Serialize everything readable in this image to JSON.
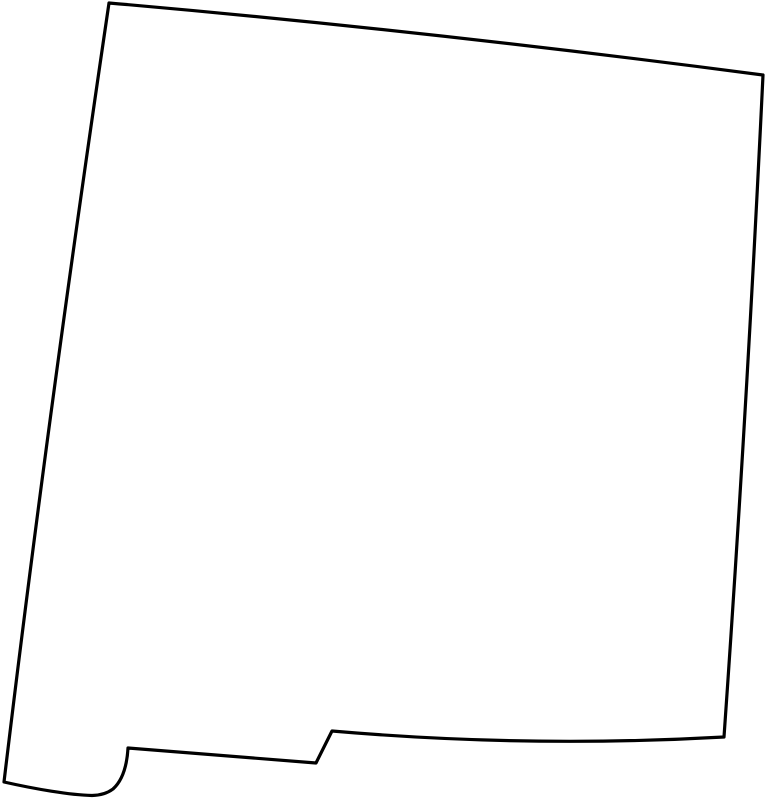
{
  "page": {
    "background_color": "#ffffff"
  },
  "map": {
    "region_label": "New Mexico",
    "kind": "blank-state-outline-map",
    "stroke_color": "#000000",
    "fill_color": "#ffffff",
    "stroke_width": "3.2",
    "viewbox": "0 0 769 800",
    "outline_path": "M 109,3 Q 420,30 763,75 Q 747,410 724,737 Q 528,748 332,731 L 316,763 L 128,748 C 127,765 123,780 113,789 C 107,793.5 100,795.3 92,795.5 C 70,795 35,789 4,782 Q 46,430 109,3 Z"
  }
}
